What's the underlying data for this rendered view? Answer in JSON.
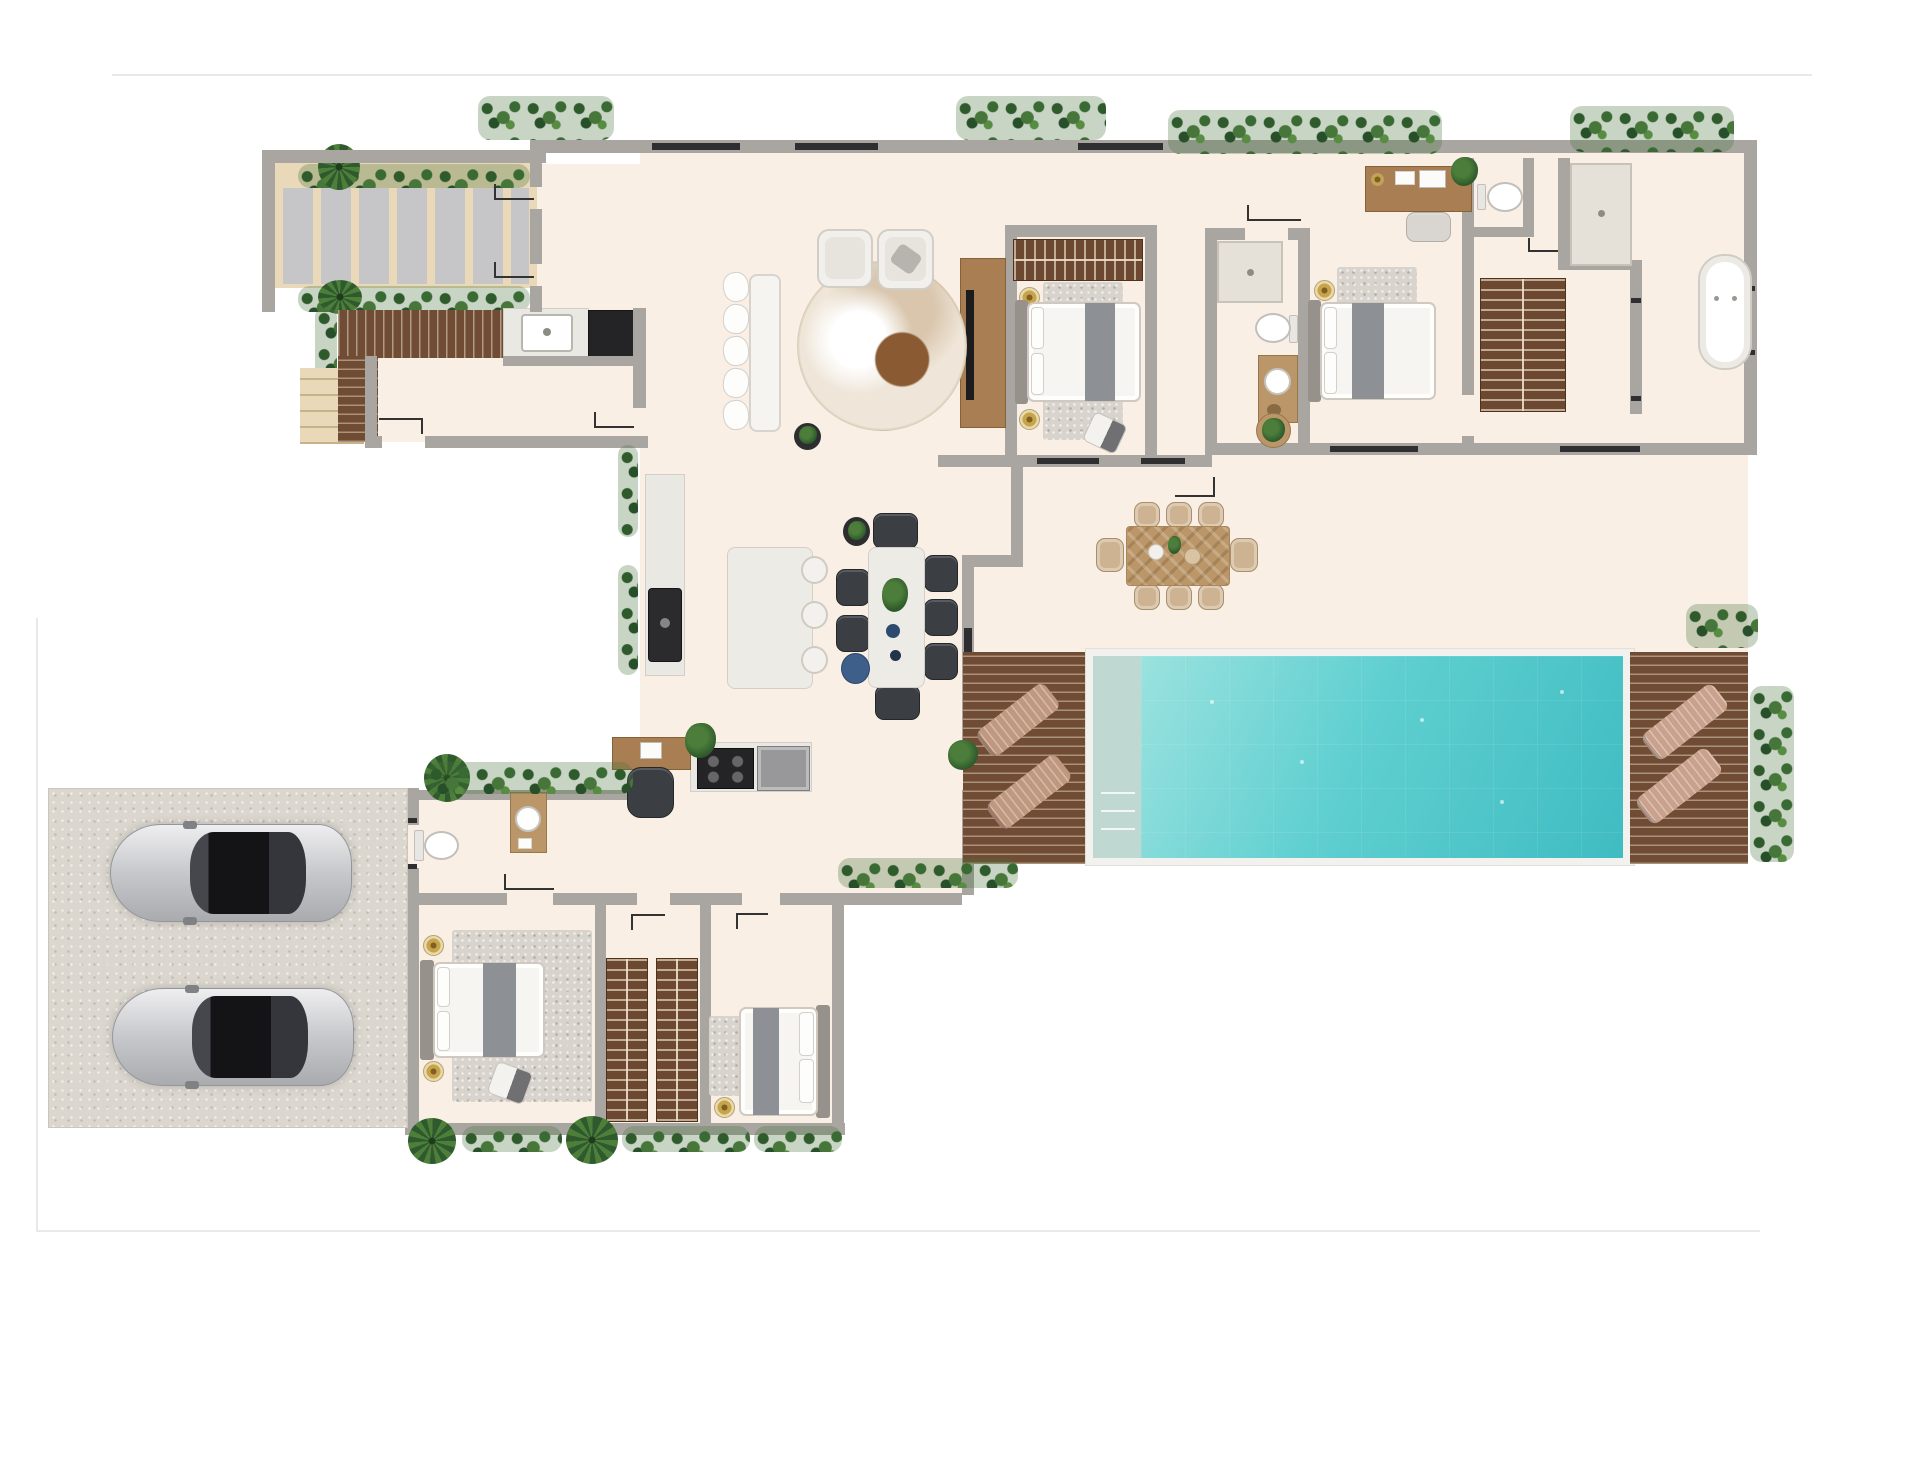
{
  "meta": {
    "kind": "architectural-floor-plan-rendering",
    "view": "top-down 3d render",
    "visible_text": ""
  },
  "palette": {
    "floor": "#f9efe5",
    "wall": "#a9a6a2",
    "wall-window": "#2f2f31",
    "patio-sand": "#ead9b8",
    "stone-slab": "#c6c6c8",
    "deck-wood": "#6f4c33",
    "wardrobe-wood": "#6d4830",
    "wood-mid": "#a87e52",
    "wood-light": "#bb9668",
    "counter": "#eae8e3",
    "appliance-dark": "#242426",
    "appliance-gray": "#98989a",
    "marble": "#edebe6",
    "water-a": "#9ae2df",
    "water-b": "#3fbcc2",
    "pool-steps": "#bfd8d2",
    "pool-rim": "#f2f1ee",
    "lounger-tan": "#c0977f",
    "lounger-pink": "#c9a18d",
    "hedge-a": "#2e5a2c",
    "hedge-b": "#578c42",
    "palm-green": "#2f5a2d",
    "driveway": "#dbd7cf",
    "car-silver-a": "#eeeef0",
    "car-silver-b": "#a9abae",
    "car-glass": "#141416",
    "runner-gray": "#8d9094",
    "chair-dark": "#3b3f43",
    "rug-light": "#d8d3cc",
    "gold": "#c6a34c",
    "pouf-blue": "#3e5f8a",
    "wicker": "#cdb392",
    "shower": "#e5e0d8",
    "border-faint": "#ebe9e7"
  },
  "inventory": {
    "bedrooms": 4,
    "beds": 4,
    "bathrooms": 3,
    "toilets": 4,
    "showers": 2,
    "bathtubs": 1,
    "wardrobes": 5,
    "cars": 2,
    "pool": 1,
    "sun_loungers": 4,
    "outdoor_dining_seats": 8,
    "indoor_dining_seats": 7,
    "island_stools": 3,
    "desks": 2,
    "sofas": 1,
    "armchairs": 2
  },
  "rooms": [
    {
      "name": "pergola-patio",
      "items": [
        "stone-slab-paving",
        "planters",
        "palm-trees"
      ]
    },
    {
      "name": "outdoor-kitchen-deck",
      "items": [
        "wood-deck",
        "counter",
        "sink",
        "grill"
      ]
    },
    {
      "name": "living-room",
      "items": [
        "sofa",
        "armchair",
        "armchair",
        "round-rug",
        "tv-console",
        "plant"
      ]
    },
    {
      "name": "kitchen",
      "items": [
        "wall-counter",
        "dark-sink",
        "island",
        "stools",
        "cooktop",
        "oven"
      ]
    },
    {
      "name": "indoor-dining",
      "items": [
        "marble-table",
        "dark-chairs",
        "blue-pouf",
        "side-table"
      ]
    },
    {
      "name": "bedroom-1",
      "items": [
        "wardrobe",
        "double-bed",
        "rug",
        "lamps",
        "ottoman"
      ]
    },
    {
      "name": "bathroom-1",
      "items": [
        "shower",
        "toilet",
        "vanity-sink"
      ]
    },
    {
      "name": "bedroom-2-master",
      "items": [
        "double-bed",
        "rug",
        "lamp",
        "desk",
        "chair"
      ]
    },
    {
      "name": "master-bathroom",
      "items": [
        "wc-toilet",
        "shower",
        "wardrobe",
        "bathtub"
      ]
    },
    {
      "name": "terrace",
      "items": [
        "outdoor-dining-table",
        "wicker-chairs",
        "plant-table"
      ]
    },
    {
      "name": "pool-area",
      "items": [
        "pool",
        "entry-steps",
        "wood-deck-left",
        "wood-deck-right",
        "sun-loungers",
        "hedges"
      ]
    },
    {
      "name": "hallway",
      "items": [
        "powder-toilet",
        "laundry-cabinet",
        "study-desk",
        "chair",
        "plant"
      ]
    },
    {
      "name": "bedroom-3",
      "items": [
        "double-bed",
        "rug",
        "lamps",
        "ottoman"
      ]
    },
    {
      "name": "walk-in-closet",
      "items": [
        "wardrobe",
        "wardrobe"
      ]
    },
    {
      "name": "bedroom-4",
      "items": [
        "double-bed",
        "rug",
        "lamp"
      ]
    },
    {
      "name": "driveway-garage",
      "items": [
        "car",
        "car"
      ]
    }
  ]
}
